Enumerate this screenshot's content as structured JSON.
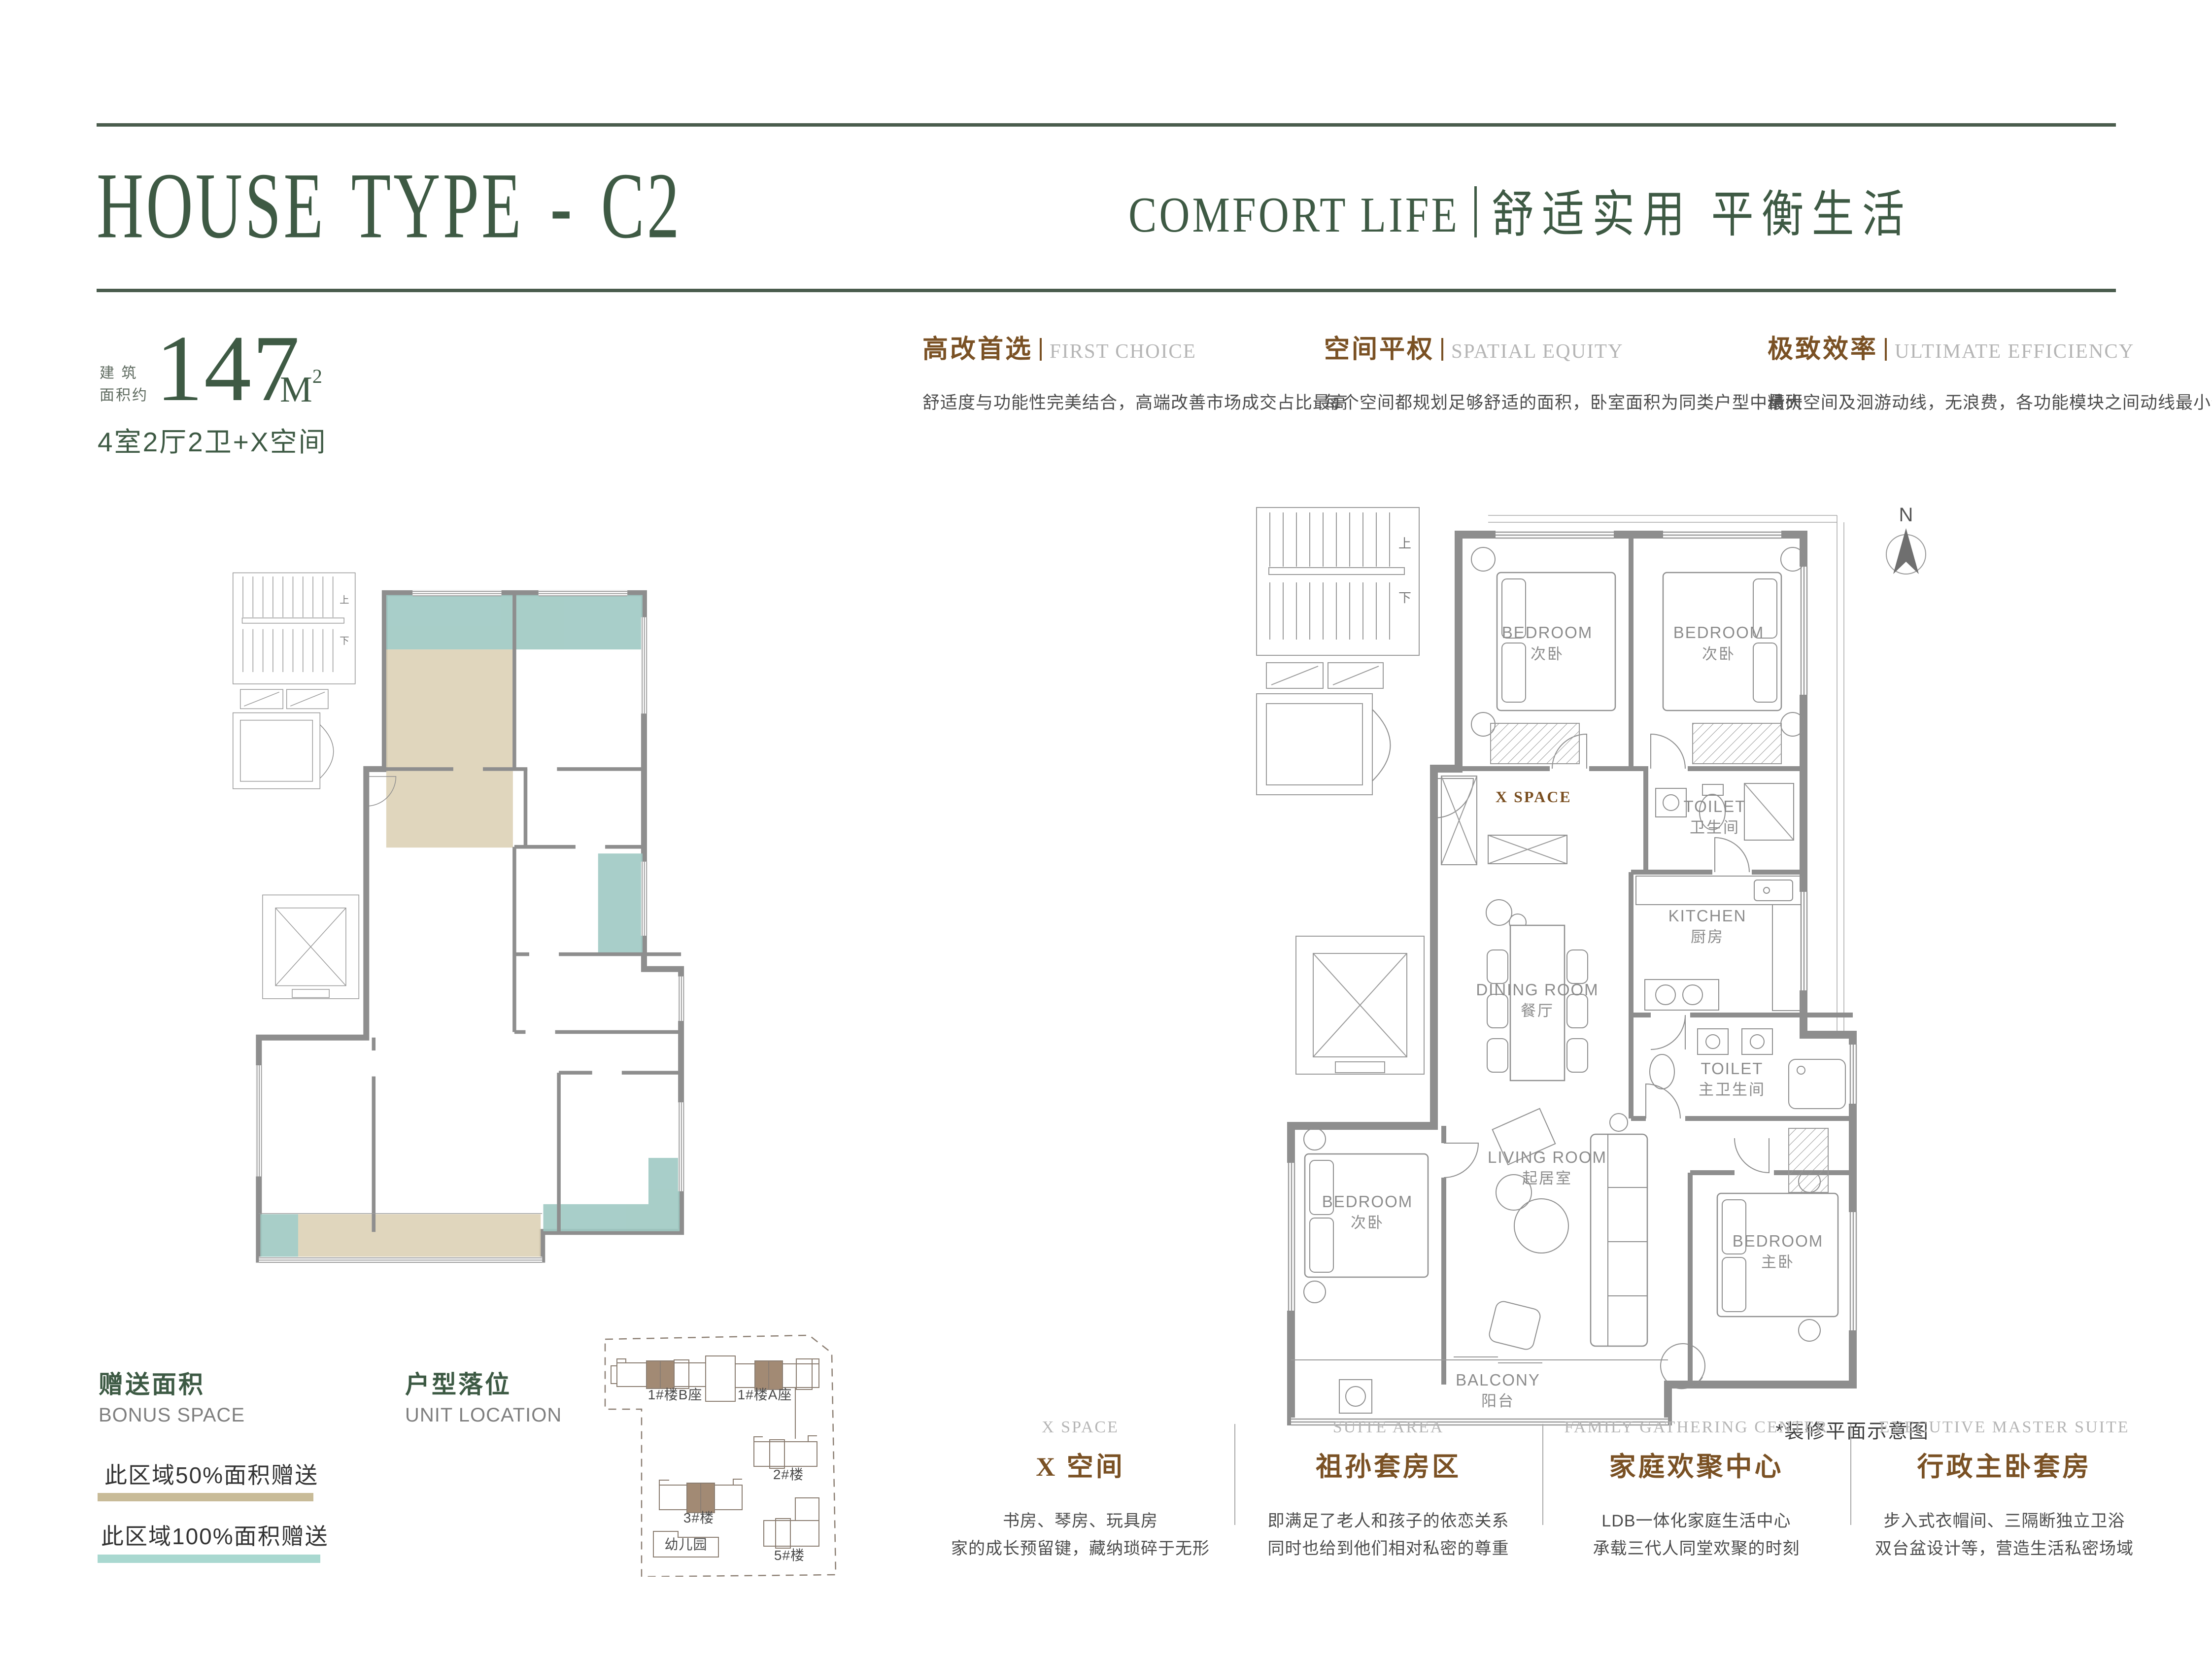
{
  "header": {
    "title": "HOUSE TYPE - C2",
    "tagline_en": "COMFORT LIFE",
    "tagline_cn": "舒适实用 平衡生活"
  },
  "area": {
    "label_line1": "建 筑",
    "label_line2": "面积约",
    "value": "147",
    "unit": "M",
    "unit_sup": "2",
    "layout": "4室2厅2卫+X空间"
  },
  "features_top": [
    {
      "cn": "高改首选",
      "en": "FIRST CHOICE",
      "desc": "舒适度与功能性完美结合，高端改善市场成交占比最高"
    },
    {
      "cn": "空间平权",
      "en": "SPATIAL EQUITY",
      "desc": "每个空间都规划足够舒适的面积，卧室面积为同类户型中最大"
    },
    {
      "cn": "极致效率",
      "en": "ULTIMATE EFFICIENCY",
      "desc": "精研空间及洄游动线，无浪费，各功能模块之间动线最小化"
    }
  ],
  "legend": {
    "bonus_cn": "赠送面积",
    "bonus_en": "BONUS SPACE",
    "item_50": "此区域50%面积赠送",
    "item_100": "此区域100%面积赠送",
    "color_50": "#C8BB98",
    "color_100": "#A9D8D0",
    "location_cn": "户型落位",
    "location_en": "UNIT LOCATION"
  },
  "site_plan": {
    "b1b": "1#楼B座",
    "b1a": "1#楼A座",
    "b2": "2#楼",
    "b3": "3#楼",
    "b5": "5#楼",
    "kindergarten": "幼儿园"
  },
  "floorplan": {
    "north": "N",
    "x_space": "X SPACE",
    "caption": "*装修平面示意图",
    "stair_up": "上",
    "stair_down": "下",
    "rooms": {
      "bed_tl": {
        "en": "BEDROOM",
        "cn": "次卧"
      },
      "bed_tr": {
        "en": "BEDROOM",
        "cn": "次卧"
      },
      "toilet": {
        "en": "TOILET",
        "cn": "卫生间"
      },
      "kitchen": {
        "en": "KITCHEN",
        "cn": "厨房"
      },
      "dining": {
        "en": "DINING ROOM",
        "cn": "餐厅"
      },
      "toilet_master": {
        "en": "TOILET",
        "cn": "主卫生间"
      },
      "bed_bl": {
        "en": "BEDROOM",
        "cn": "次卧"
      },
      "living": {
        "en": "LIVING ROOM",
        "cn": "起居室"
      },
      "bed_master": {
        "en": "BEDROOM",
        "cn": "主卧"
      },
      "balcony": {
        "en": "BALCONY",
        "cn": "阳台"
      }
    }
  },
  "features_bottom": [
    {
      "en": "X SPACE",
      "cn": "X 空间",
      "line1": "书房、琴房、玩具房",
      "line2": "家的成长预留键，藏纳琐碎于无形"
    },
    {
      "en": "SUITE AREA",
      "cn": "祖孙套房区",
      "line1": "即满足了老人和孩子的依恋关系",
      "line2": "同时也给到他们相对私密的尊重"
    },
    {
      "en": "FAMILY GATHERING CENTER",
      "cn": "家庭欢聚中心",
      "line1": "LDB一体化家庭生活中心",
      "line2": "承载三代人同堂欢聚的时刻"
    },
    {
      "en": "EXECUTIVE MASTER SUITE",
      "cn": "行政主卧套房",
      "line1": "步入式衣帽间、三隔断独立卫浴",
      "line2": "双台盆设计等，营造生活私密场域"
    }
  ],
  "colors": {
    "brand_green": "#3E5A44",
    "accent_brown": "#7A5124",
    "bonus_teal": "#9FC9C3",
    "bonus_beige": "#DDD2B6",
    "wall_gray": "#8E8E8E"
  }
}
